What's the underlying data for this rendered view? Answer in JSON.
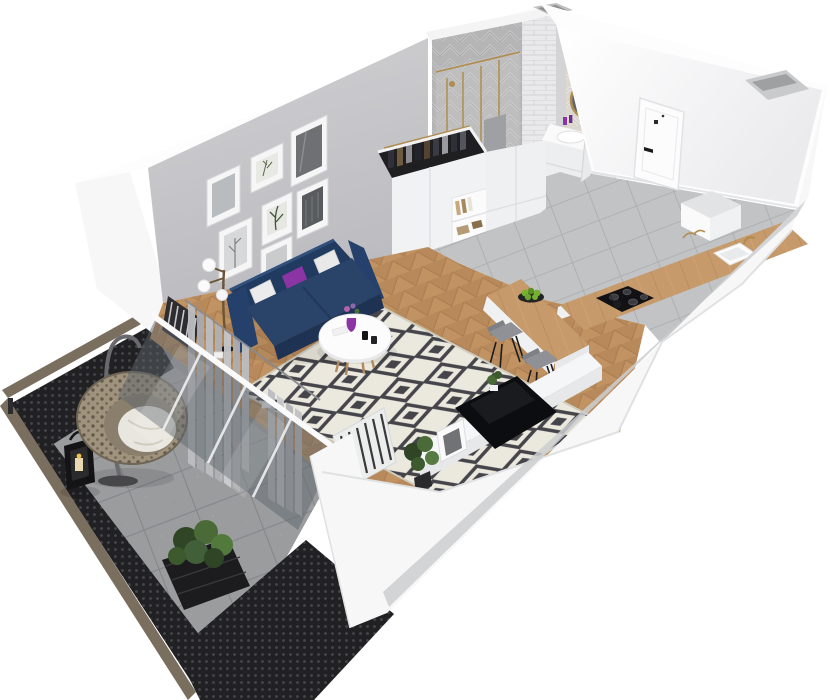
{
  "scene": {
    "kind": "3d-apartment-floor-plan-render",
    "view": "isometric cutaway from above",
    "background": "#ffffff"
  },
  "colors": {
    "background": "#ffffff",
    "wall_bright": "#fdfdfe",
    "wall_white": "#f7f7f8",
    "wall_shade": "#cdced0",
    "wall_interior_top": "#d0d0d3",
    "wall_interior_bottom": "#bdbdc1",
    "wood_floor": "#b8895a",
    "wood_floor_light": "#c89a68",
    "wood_grout": "#9c6f45",
    "tile_floor": "#c2c3c5",
    "tile_grout": "#aaabad",
    "balcony_tile": "#9b9c9e",
    "balcony_grout": "#85868a",
    "mesh_dark": "#212124",
    "rail_cap": "#7a6e5e",
    "rug_base": "#ebe8dd",
    "rug_motif": "#45444a",
    "sofa_navy": "#2a4368",
    "sofa_navy_dark": "#1e3254",
    "sofa_back": "#203a60",
    "pillow_purple": "#8a35a3",
    "pillow_white": "#ececec",
    "curtain_gray": "#bdbec2",
    "curtain_dark": "#a9aaaf",
    "glass_panel": "#5d666c",
    "counter_wood": "#c69a6b",
    "cooktop_black": "#121214",
    "stool_gray": "#8f9196",
    "tv_black": "#0c0d10",
    "console_white": "#f5f6f7",
    "plant_green": "#4a6b38",
    "plant_green_dark": "#2f4526",
    "apple_green": "#76b02f",
    "gold": "#b08d4f",
    "mirror_glass": "#5f6468",
    "bath_wall_gray": "#b6b5b6",
    "bath_wall_light": "#dcd8d0",
    "brick_white": "#e9e9eb",
    "chair_rattan": "#a0937e",
    "cushion_white": "#e9e6df",
    "lantern_black": "#141416",
    "door_white": "#fcfcfd",
    "bench_gray": "#e2e3e5",
    "radiator_dark": "#2e2e31"
  },
  "rooms": {
    "living_room": {
      "name": "living-room",
      "floor": "herringbone wood",
      "items": [
        "gallery wall with 7 framed prints",
        "navy three-seat sofa",
        "two white pillows",
        "purple pillow",
        "floor lamp with three globe shades",
        "round white coffee table",
        "purple vase with flowers",
        "black and white diamond rug",
        "sheer gray curtains",
        "slatted radiators",
        "white tv console",
        "flat screen tv",
        "leaning framed photo",
        "potted plants"
      ]
    },
    "kitchen": {
      "name": "kitchen-dining",
      "floor": "gray ceramic tile",
      "items": [
        "white wardrobe with hanging clothes",
        "open shelf with books",
        "tall white cabinet",
        "wood breakfast bar",
        "two gray bar stools",
        "plate of green apples",
        "wood worktop",
        "black cooktop with kettle",
        "white sink with brass faucet"
      ]
    },
    "bathroom": {
      "name": "bathroom",
      "walls": "herringbone tile",
      "items": [
        "walk-in shower with brass frame",
        "wall-hung toilet",
        "white vanity with basin",
        "round brass mirror",
        "white brick column",
        "open door"
      ]
    },
    "hallway": {
      "name": "entry-hall",
      "floor": "gray ceramic tile",
      "items": [
        "white entry door with black handle",
        "gray bench",
        "wall shaft recess"
      ]
    },
    "balcony": {
      "name": "balcony",
      "floor": "gray stone tile",
      "items": [
        "perforated metal railing with taupe cap",
        "hanging egg chair with white cushion",
        "black candle lantern",
        "black planter with shrub"
      ]
    }
  }
}
